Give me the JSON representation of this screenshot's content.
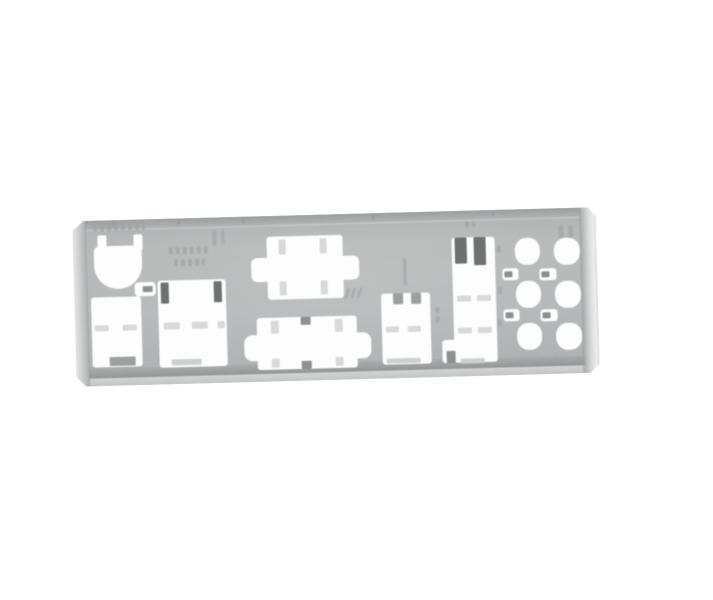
{
  "scene": {
    "type": "product-photo",
    "subject": "Metal motherboard rear-panel I/O shield plate photographed at a slight angle on a plain white background",
    "background_color": "#ffffff"
  },
  "plate": {
    "face_color": "#b6b9b9",
    "top_edge_color": "#9b9e9e",
    "bottom_shadow_color": "#939696",
    "bottom_flange_color": "#d3d5d5",
    "rolled_edge_color": "#e6e8e8",
    "cutout_color": "#fdfdfd",
    "dark_tab_color": "#6e7171",
    "marking_color": "#a2a5a5",
    "markings_note": "Faint embossed stamp markings, illegible in photo",
    "cutouts": [
      {
        "id": "ps2-port",
        "label": "PS/2 keyboard/mouse port cutout"
      },
      {
        "id": "small-slot",
        "label": "Small indicator slot cutout"
      },
      {
        "id": "left-usb-block",
        "label": "Left USB ports cutout"
      },
      {
        "id": "left-lan-block",
        "label": "Left LAN/USB block cutout with latch slots"
      },
      {
        "id": "serial-port",
        "label": "Serial port cutout with jack-screw wings"
      },
      {
        "id": "parallel-port",
        "label": "Wide parallel port cutout with jack-screw wings"
      },
      {
        "id": "usb-stack",
        "label": "USB stack cutout with grounding tabs"
      },
      {
        "id": "lan-usb-tower",
        "label": "LAN and USB tower cutout with grounding fingers"
      },
      {
        "id": "audio-jack-1",
        "label": "Round audio jack cutout"
      },
      {
        "id": "audio-jack-2",
        "label": "Round audio jack cutout"
      },
      {
        "id": "audio-jack-3",
        "label": "Round audio jack cutout"
      },
      {
        "id": "audio-jack-4",
        "label": "Round audio jack cutout"
      },
      {
        "id": "audio-jack-5",
        "label": "Round audio jack cutout"
      },
      {
        "id": "audio-jack-6",
        "label": "Round audio jack cutout"
      },
      {
        "id": "indicator-window-1",
        "label": "Indicator window cutout"
      },
      {
        "id": "indicator-window-2",
        "label": "Indicator window cutout"
      },
      {
        "id": "indicator-window-3",
        "label": "Indicator window cutout"
      },
      {
        "id": "indicator-window-4",
        "label": "Indicator window cutout"
      }
    ]
  }
}
